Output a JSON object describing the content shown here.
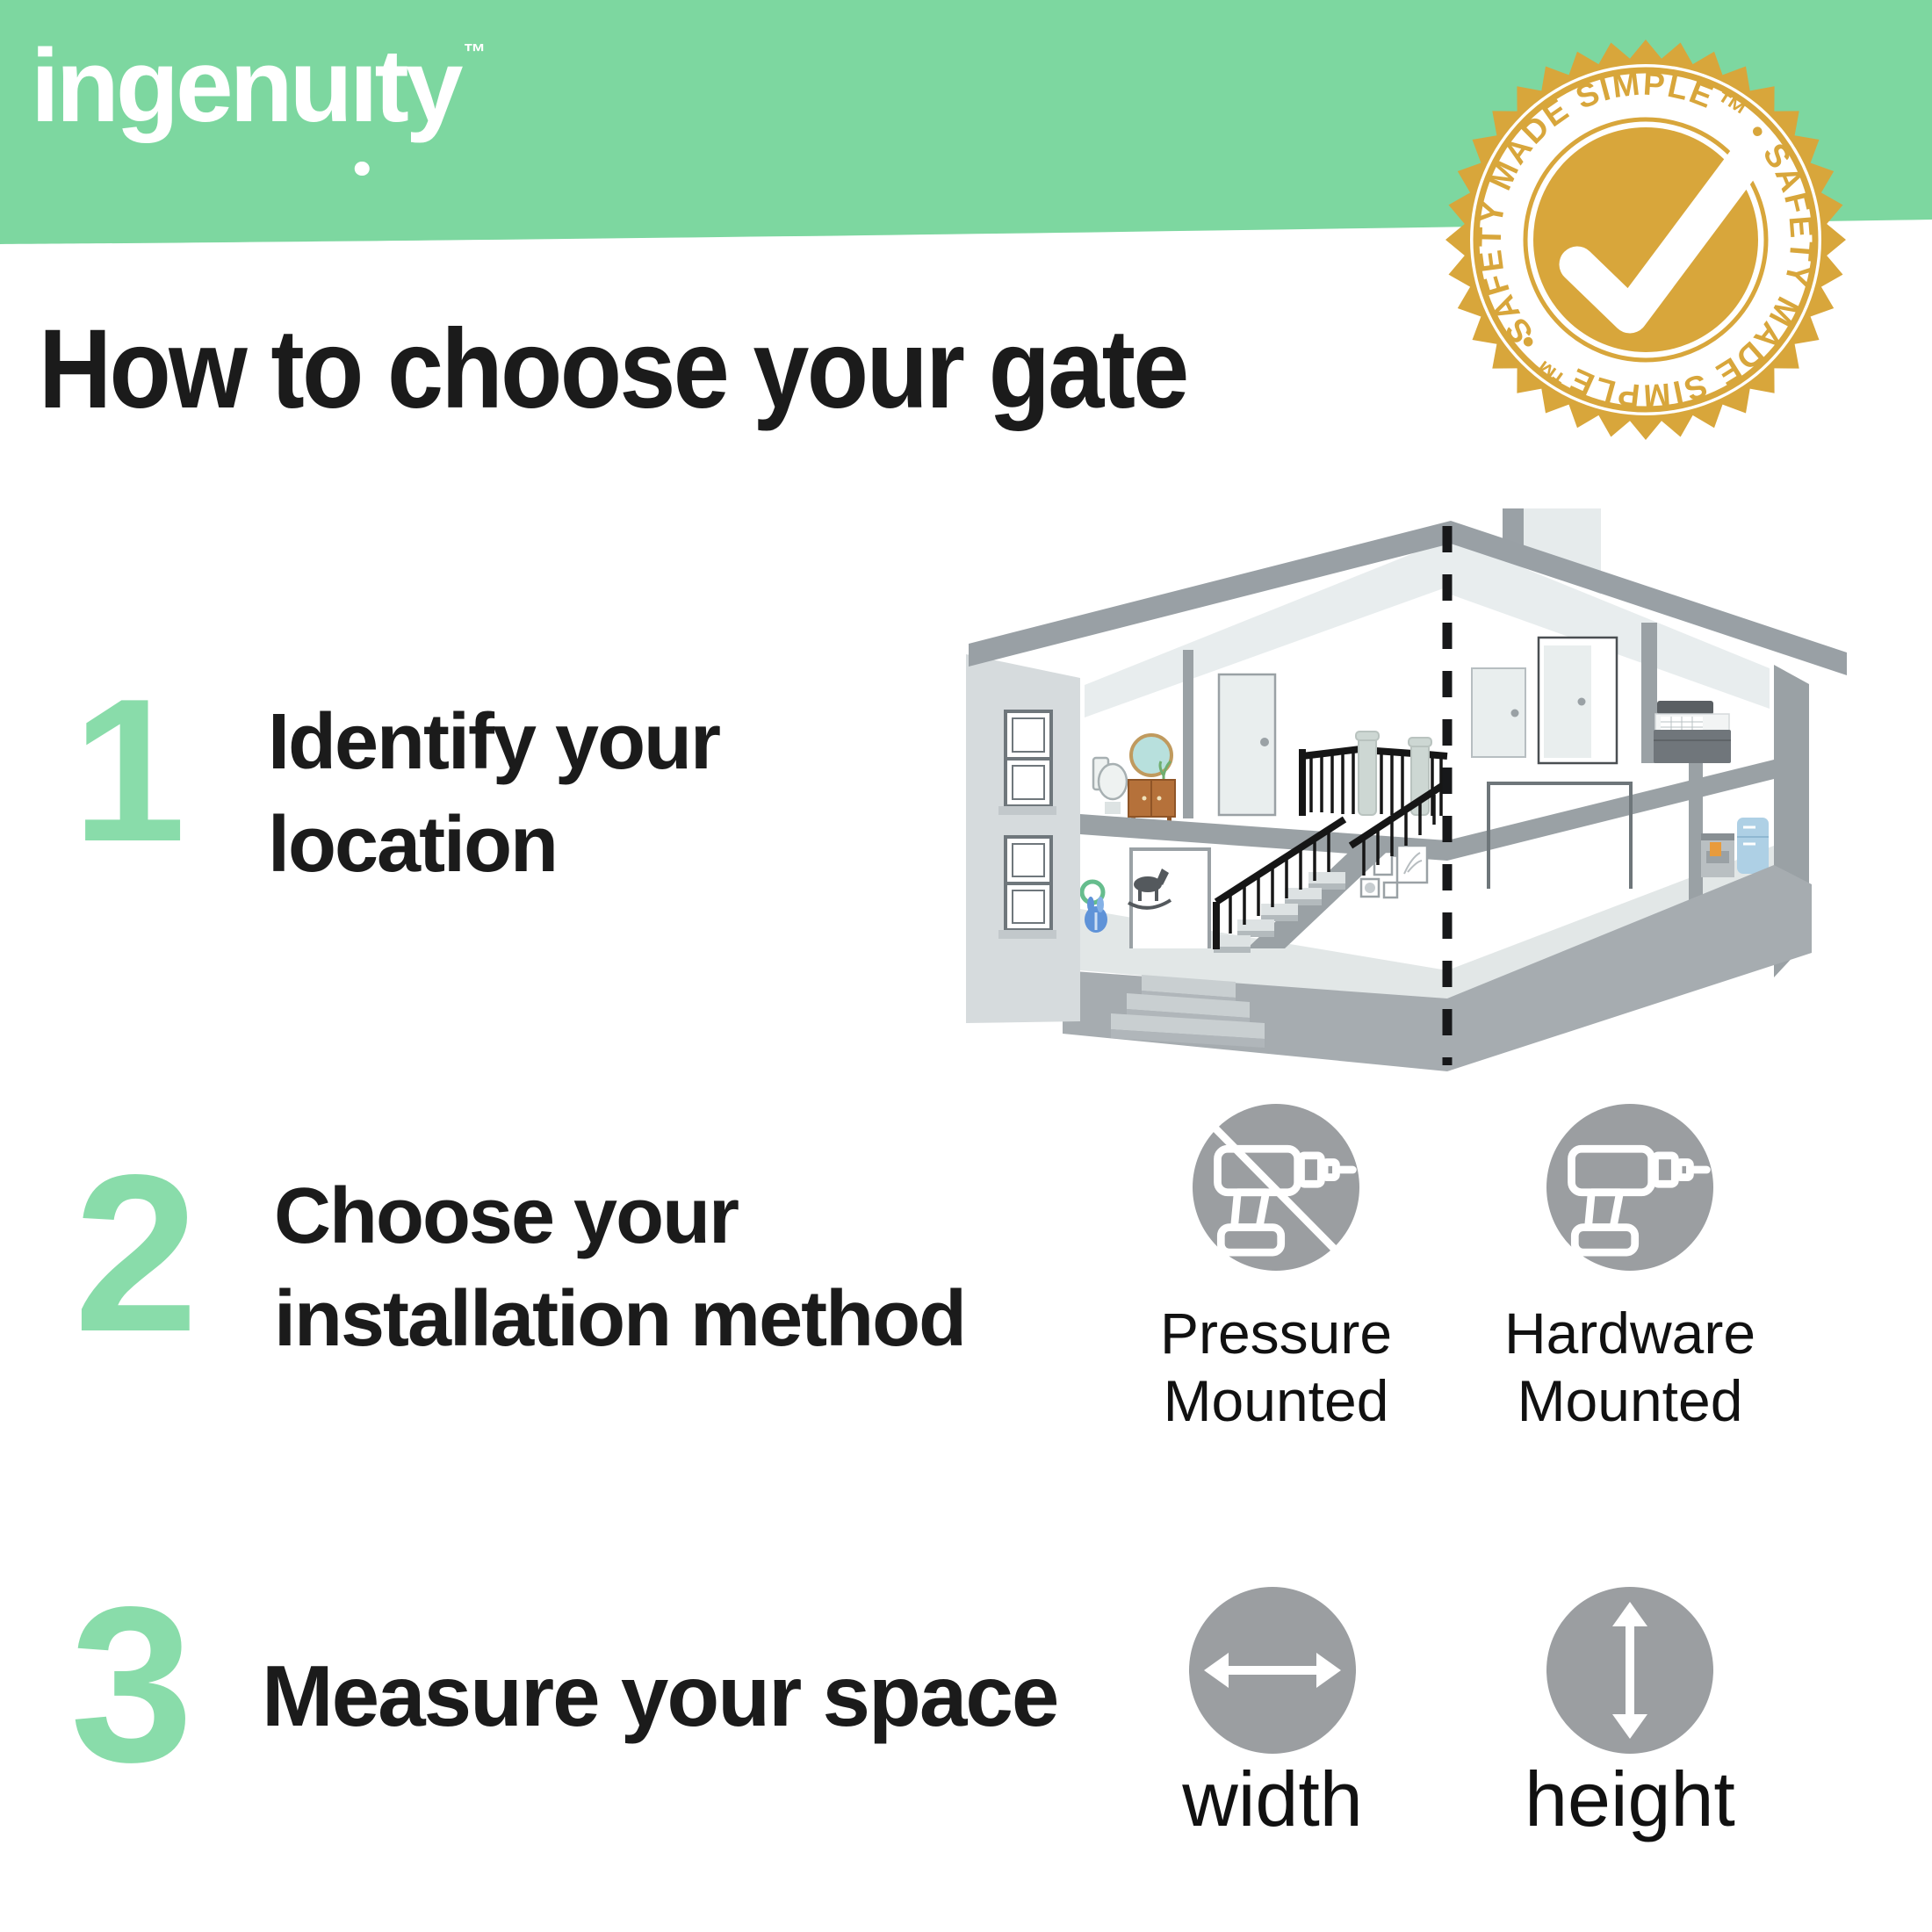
{
  "brand": {
    "logo_part1": "ingenu",
    "logo_dotless_i": "ı",
    "logo_part2": "ty",
    "tm": "™"
  },
  "badge": {
    "ring_text": "SAFETY MADE SIMPLE™  •  SAFETY MADE SIMPLE™  •  ",
    "icon": "checkmark-icon",
    "gold": "#d8a63b"
  },
  "title": "How to choose your gate",
  "steps": [
    {
      "num": "1",
      "line1": "Identify your",
      "line2": "location"
    },
    {
      "num": "2",
      "line1": "Choose your",
      "line2": "installation method"
    },
    {
      "num": "3",
      "line1": "Measure your space",
      "line2": ""
    }
  ],
  "methods": [
    {
      "line1": "Pressure",
      "line2": "Mounted",
      "icon": "drill-crossed-icon"
    },
    {
      "line1": "Hardware",
      "line2": "Mounted",
      "icon": "drill-icon"
    }
  ],
  "measures": [
    {
      "label": "width",
      "icon": "horizontal-double-arrow-icon"
    },
    {
      "label": "height",
      "icon": "vertical-double-arrow-icon"
    }
  ],
  "illustration": {
    "name": "two-story house cutaway with stairs"
  },
  "colors": {
    "header_green": "#7dd7a0",
    "numeral_green": "#89dcaa",
    "badge_gold": "#d8a63b",
    "icon_gray": "#9b9ea1",
    "text_black": "#1b1b1b"
  }
}
